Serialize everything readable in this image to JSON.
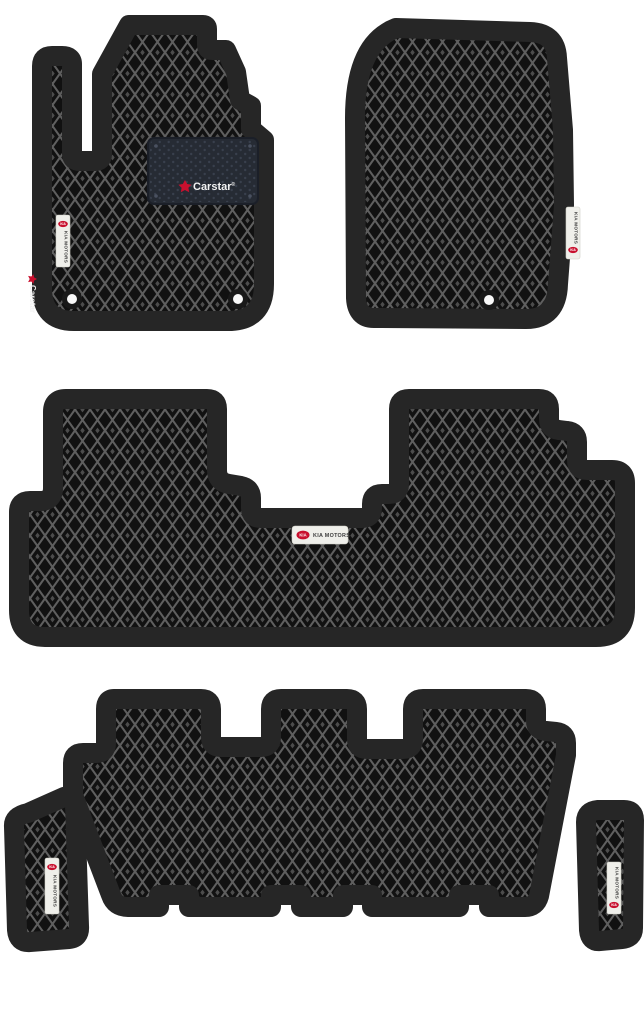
{
  "branding": {
    "heel_logo_text": "Carstar",
    "heel_logo_reg": "®",
    "side_logo_text": "Carstar",
    "tag_text": "KIA MOTORS",
    "tag_logo_text": "KIA",
    "accent_red": "#c8102e",
    "tag_bg": "#efefea"
  },
  "colors": {
    "background": "#ffffff",
    "mat_border": "#262626",
    "mat_base": "#111111",
    "pattern_line": "#5f5f5f",
    "heel_pad": "#262b34",
    "fastener_ring": "#191919",
    "fastener_center": "#f8f8f8"
  }
}
